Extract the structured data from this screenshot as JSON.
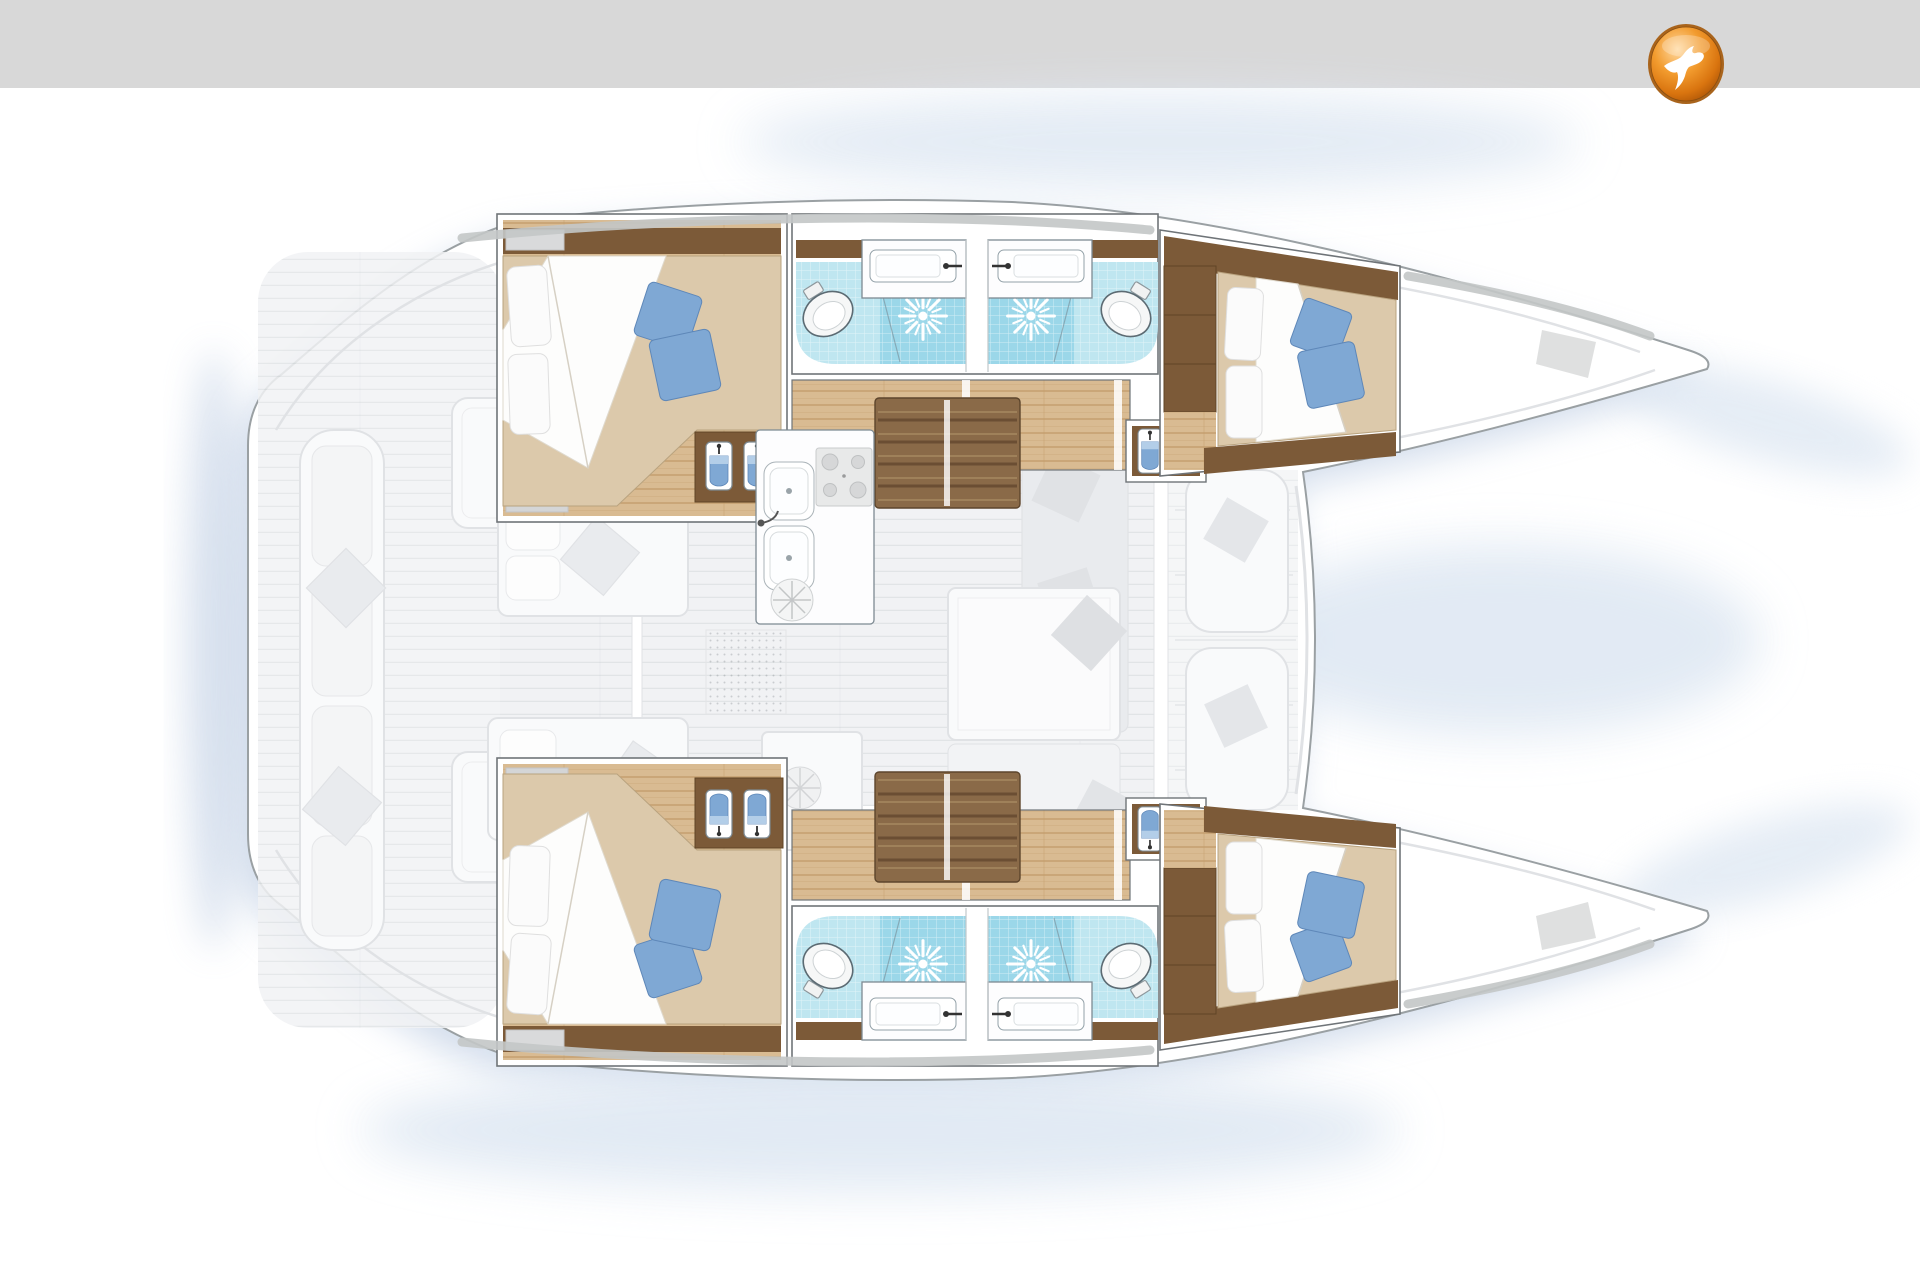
{
  "meta": {
    "description": "Top-down interior layout plan (floor plan) of a four-cabin sailing catamaran; bows point right, twin hulls top and bottom, ghosted saloon, galley and cockpit deck in the centre. No text labels are printed on the drawing.",
    "visible_text": []
  },
  "header": {
    "role": "blank gray title bar"
  },
  "logo": {
    "name": "yacht-broker-badge",
    "glyph": "white seagull on a glossy orange circular medallion with bronze rim",
    "colors": {
      "orange": "#f29b2e",
      "orange_dark": "#b45a08",
      "rim": "#a9641c",
      "bird": "#ffffff"
    }
  },
  "palette": {
    "header": "#d8d8d8",
    "hullstroke": "#9aa0a3",
    "cap": "#c3c6c7",
    "glow": "#a9bdda",
    "fog": "#dfe8f3",
    "wood": "#7c5a38",
    "stairwood": "#8a6a48",
    "stairtread": "#6b4e33",
    "plank": "#d9bb92",
    "plankline": "#c19a6a",
    "mattress": "#dcc9ab",
    "pillow": "#fbfbfb",
    "blue": "#7fa8d4",
    "bluedark": "#5e87b8",
    "tile": "#bfe6f0",
    "tiledark": "#9bd7e9",
    "fixstroke": "#7d8a92",
    "ghost": "#f1f2f4",
    "ghostline": "#e0e2e5",
    "ghostfurn": "#e9ebee",
    "modstroke": "#6f7478",
    "orange": "#f29b2e",
    "orangedark": "#b45a08",
    "rim": "#a9641c"
  },
  "plan": {
    "orientation": {
      "bow": "right",
      "stern": "left",
      "port_hull": "top",
      "starboard_hull": "bottom"
    },
    "counts": {
      "cabins": 4,
      "bathrooms": 4,
      "toilets": 4,
      "showers": 4,
      "double_berths": 4,
      "companionway_stairs": 2
    },
    "hulls": [
      {
        "id": "port",
        "position": "top",
        "rooms": [
          {
            "name": "aft double cabin",
            "furniture": [
              "double bed",
              "2 white pillows",
              "2 blue cushions",
              "white sheet fold",
              "wood vanity with 2 basins",
              "deck hatches"
            ]
          },
          {
            "name": "aft bathroom",
            "fixtures": [
              "toilet",
              "washbasin with faucet",
              "shower with drain rose",
              "blue mosaic floor"
            ]
          },
          {
            "name": "forward bathroom",
            "fixtures": [
              "toilet",
              "washbasin with faucet",
              "shower with drain rose",
              "blue mosaic floor"
            ]
          },
          {
            "name": "companionway stairs",
            "steps": 5
          },
          {
            "name": "corridor",
            "floor": "teak planks"
          },
          {
            "name": "forward double cabin",
            "furniture": [
              "double bed",
              "2 white pillows",
              "2 blue cushions",
              "wardrobe",
              "vanity with 2 basins"
            ]
          },
          {
            "name": "bow locker",
            "note": "empty ghosted foredeck with anchor hatch"
          }
        ]
      },
      {
        "id": "starboard",
        "position": "bottom",
        "rooms": [
          {
            "name": "aft double cabin",
            "furniture": [
              "double bed",
              "2 white pillows",
              "2 blue cushions",
              "white sheet fold",
              "wood vanity with 2 basins",
              "deck hatches"
            ]
          },
          {
            "name": "aft bathroom",
            "fixtures": [
              "toilet",
              "washbasin with faucet",
              "shower with drain rose",
              "blue mosaic floor"
            ]
          },
          {
            "name": "forward bathroom",
            "fixtures": [
              "toilet",
              "washbasin with faucet",
              "shower with drain rose",
              "blue mosaic floor"
            ]
          },
          {
            "name": "companionway stairs",
            "steps": 5
          },
          {
            "name": "corridor",
            "floor": "teak planks"
          },
          {
            "name": "forward double cabin",
            "furniture": [
              "double bed",
              "2 white pillows",
              "2 blue cushions",
              "wardrobe",
              "vanity with 2 basins"
            ]
          },
          {
            "name": "bow locker",
            "note": "empty ghosted foredeck with anchor hatch"
          }
        ]
      }
    ],
    "center_deck": {
      "galley": {
        "fixtures": [
          "double sink",
          "faucet",
          "4-burner stove",
          "round hatch"
        ]
      },
      "saloon_ghosted": {
        "furniture": [
          "dinette table",
          "L-shaped sofa",
          "bench",
          "scatter cushions",
          "day bed",
          "nav unit with fan"
        ]
      },
      "cockpit_ghosted": {
        "furniture": [
          "transom bench with cushions",
          "2 cockpit tables",
          "diamond scatter cushions"
        ]
      },
      "foredeck_ghosted": {
        "furniture": [
          "2 lounge pads with cushions",
          "walkway between hulls"
        ]
      }
    }
  }
}
